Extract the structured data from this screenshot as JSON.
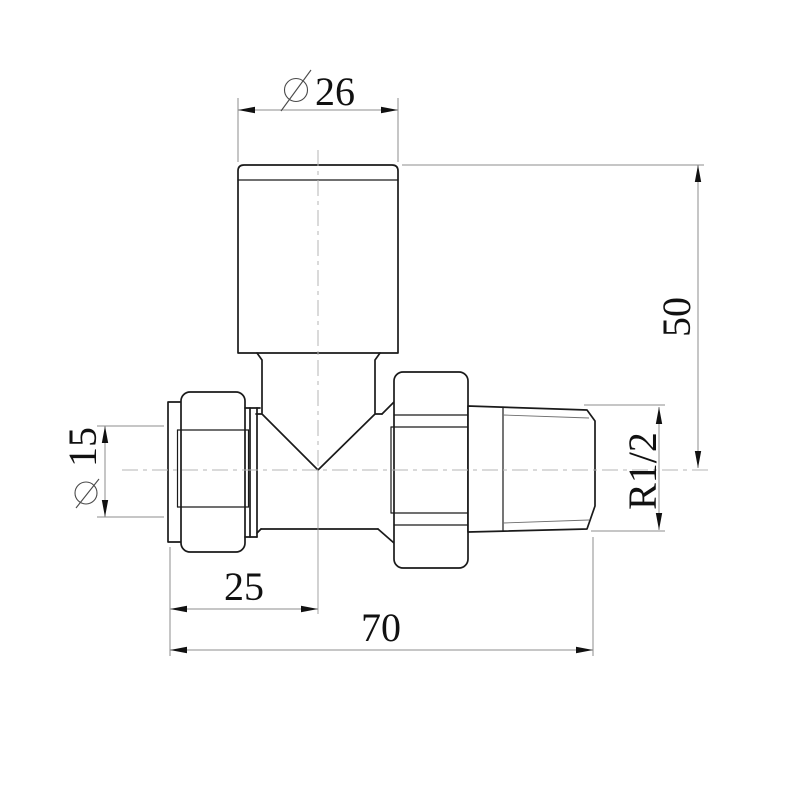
{
  "drawing": {
    "type": "technical-orthographic-drawing",
    "subject": "straight-radiator-valve",
    "dimensions": {
      "cap_diameter": {
        "prefix": "∅",
        "value": "26"
      },
      "height_to_center": {
        "value": "50"
      },
      "thread_size": {
        "value": "R1/2"
      },
      "inlet_diameter": {
        "prefix": "∅",
        "value": "15"
      },
      "center_offset": {
        "value": "25"
      },
      "overall_length": {
        "value": "70"
      }
    },
    "colors": {
      "background": "#ffffff",
      "outline": "#1a1a1a",
      "dimension_lines": "#8e8e8e",
      "centerlines": "#b5b5b5",
      "text": "#111111"
    }
  }
}
